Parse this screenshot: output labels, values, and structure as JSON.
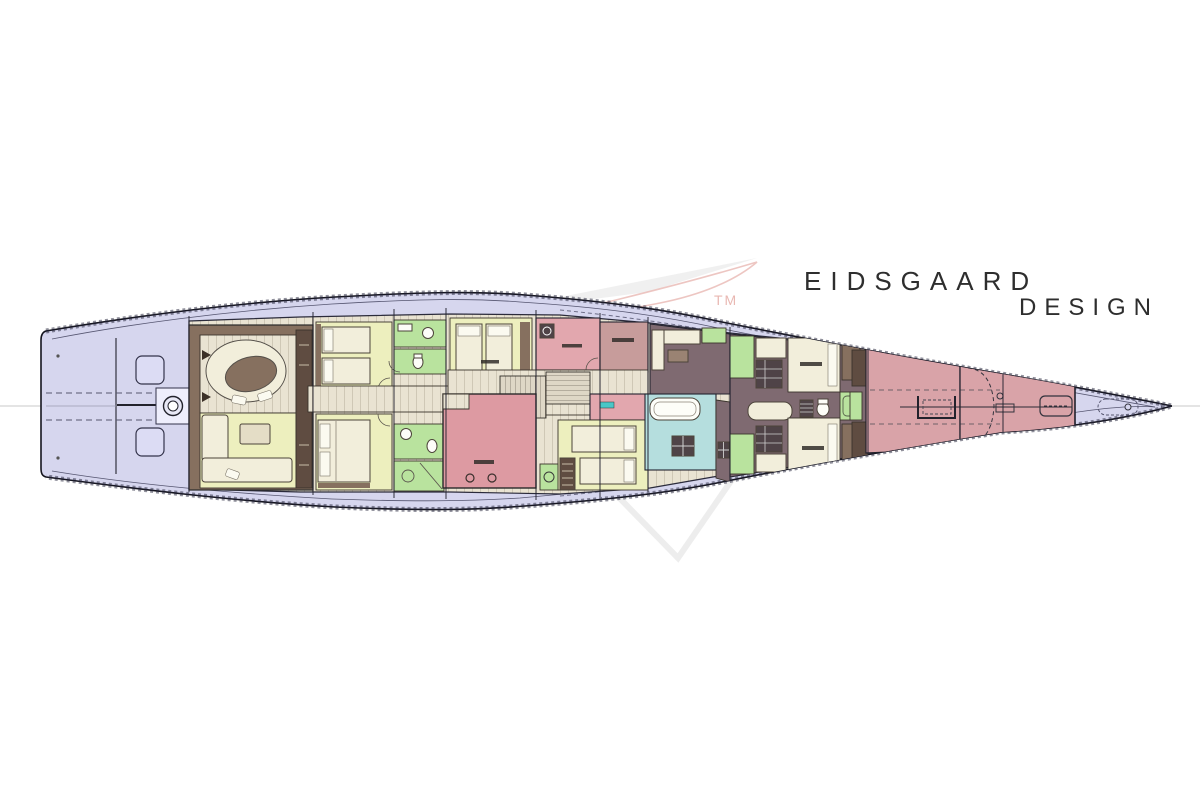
{
  "brand": {
    "line1": "EIDSGAARD",
    "line2": "DESIGN",
    "trademark": "TM",
    "text_color": "#2e2e2e",
    "watermark_red": "#dd9189",
    "watermark_grey": "#d9d9d9"
  },
  "palette": {
    "deck": "#d6d6ee",
    "hull_outline": "#15151f",
    "plank_floor": "#e9e3d2",
    "cabin_yellow": "#edefbe",
    "bath_green": "#b9e39e",
    "bath_teal": "#b5dede",
    "technical_pink": "#e2a7ae",
    "technical_pink_deep": "#dd9aa2",
    "pink_brown": "#c79c9b",
    "forepeak_pink": "#d9a3a8",
    "crew_mauve": "#7f6a71",
    "wood_brown": "#86705f",
    "wood_dark": "#5f4c41",
    "bed_cream": "#f2eedb",
    "fixture_white": "#fdfdf8",
    "cabinet_dark": "#4f4347",
    "hatch_lavender": "#dcdcf4",
    "teal_label": "#49c7c7"
  }
}
